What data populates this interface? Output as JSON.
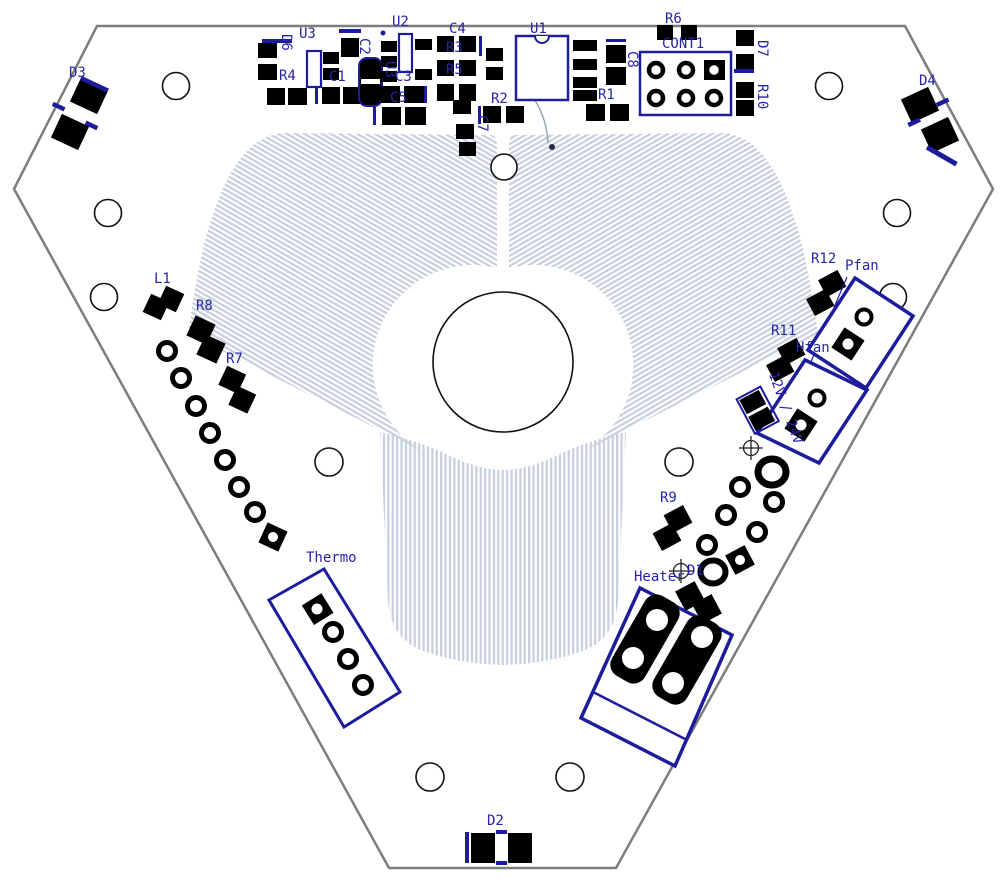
{
  "view": {
    "kind_note": "PCB layout top view, triangular board with three-lobe hatched copper zone",
    "colors": {
      "silkscreen_blue": "#2626a6",
      "outline_navy": "#1c1c9c",
      "pad_black": "#000000",
      "hatch_blue_gray": "#c6d0de",
      "board_edge_gray": "#7d7d7d",
      "background": "#ffffff"
    }
  },
  "labels": {
    "u3_top": "U3",
    "u2": "U2",
    "c4": "C4",
    "u1": "U1",
    "r6": "R6",
    "cont1": "CONT1",
    "d7": "D7",
    "d3": "D3",
    "d4": "D4",
    "d6": "D6",
    "r4": "R4",
    "c1": "C1",
    "c2": "C2",
    "u3_side": "U3",
    "c3": "C3",
    "c5": "C5",
    "r3": "R3",
    "r5": "R5",
    "r2": "R2",
    "r1": "R1",
    "c8": "C8",
    "r10": "R10",
    "c7": "C7",
    "l1": "L1",
    "r8": "R8",
    "r7": "R7",
    "r12": "R12",
    "pfan": "Pfan",
    "r11": "R11",
    "hfan": "Hfan",
    "supply": "12V / 24V",
    "r9": "R9",
    "heater": "Heater",
    "d1": "D1",
    "thermo": "Thermo",
    "d2": "D2"
  }
}
